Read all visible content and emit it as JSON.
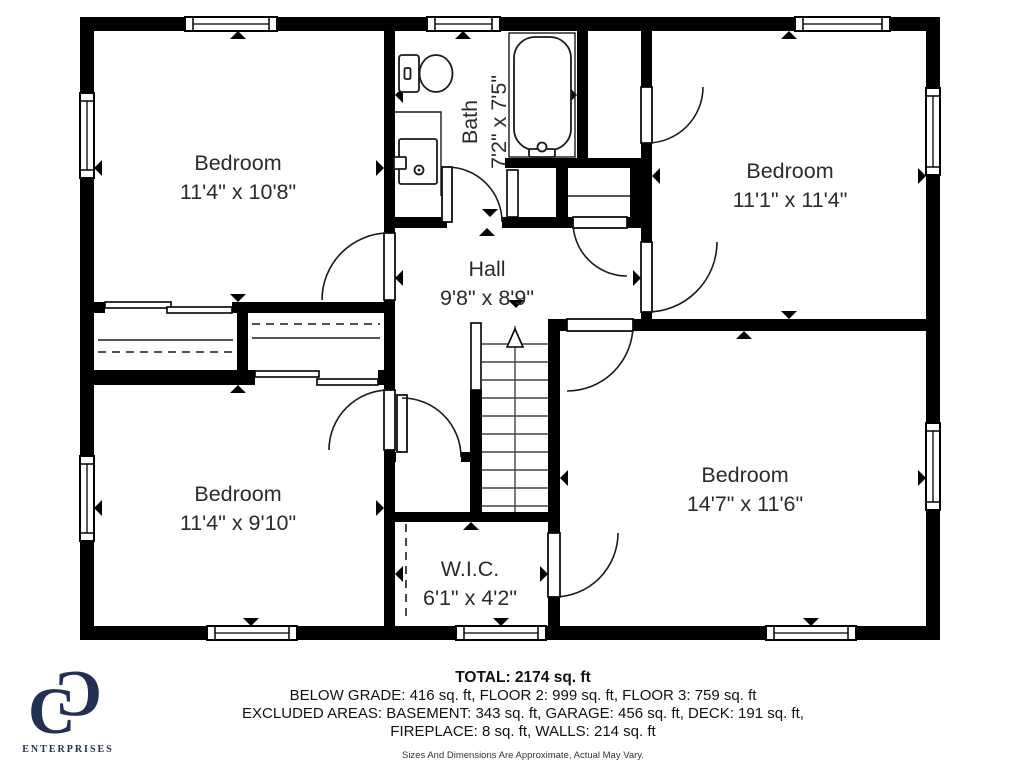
{
  "plan": {
    "rooms": [
      {
        "id": "bedroom-top-left",
        "name": "Bedroom",
        "dims": "11'4\" x 10'8\""
      },
      {
        "id": "bath",
        "name": "Bath",
        "dims": "7'2\" x 7'5\""
      },
      {
        "id": "bedroom-top-right",
        "name": "Bedroom",
        "dims": "11'1\" x 11'4\""
      },
      {
        "id": "hall",
        "name": "Hall",
        "dims": "9'8\" x 8'9\""
      },
      {
        "id": "bedroom-bottom-left",
        "name": "Bedroom",
        "dims": "11'4\" x 9'10\""
      },
      {
        "id": "wic",
        "name": "W.I.C.",
        "dims": "6'1\" x 4'2\""
      },
      {
        "id": "bedroom-bottom-right",
        "name": "Bedroom",
        "dims": "14'7\" x 11'6\""
      }
    ]
  },
  "footer": {
    "total": "TOTAL: 2174 sq. ft",
    "line2": "BELOW GRADE: 416 sq. ft, FLOOR 2: 999 sq. ft, FLOOR 3: 759 sq. ft",
    "line3": "EXCLUDED AREAS: BASEMENT: 343 sq. ft, GARAGE: 456 sq. ft, DECK: 191 sq. ft,",
    "line4": "FIREPLACE: 8 sq. ft, WALLS: 214 sq. ft",
    "disclaimer": "Sizes And Dimensions Are Approximate, Actual May Vary."
  },
  "logo": {
    "monogram_left": "C",
    "monogram_right": "C",
    "text": "ENTERPRISES",
    "color": "#233054"
  },
  "colors": {
    "wall": "#000000",
    "text": "#2b2b2b"
  }
}
